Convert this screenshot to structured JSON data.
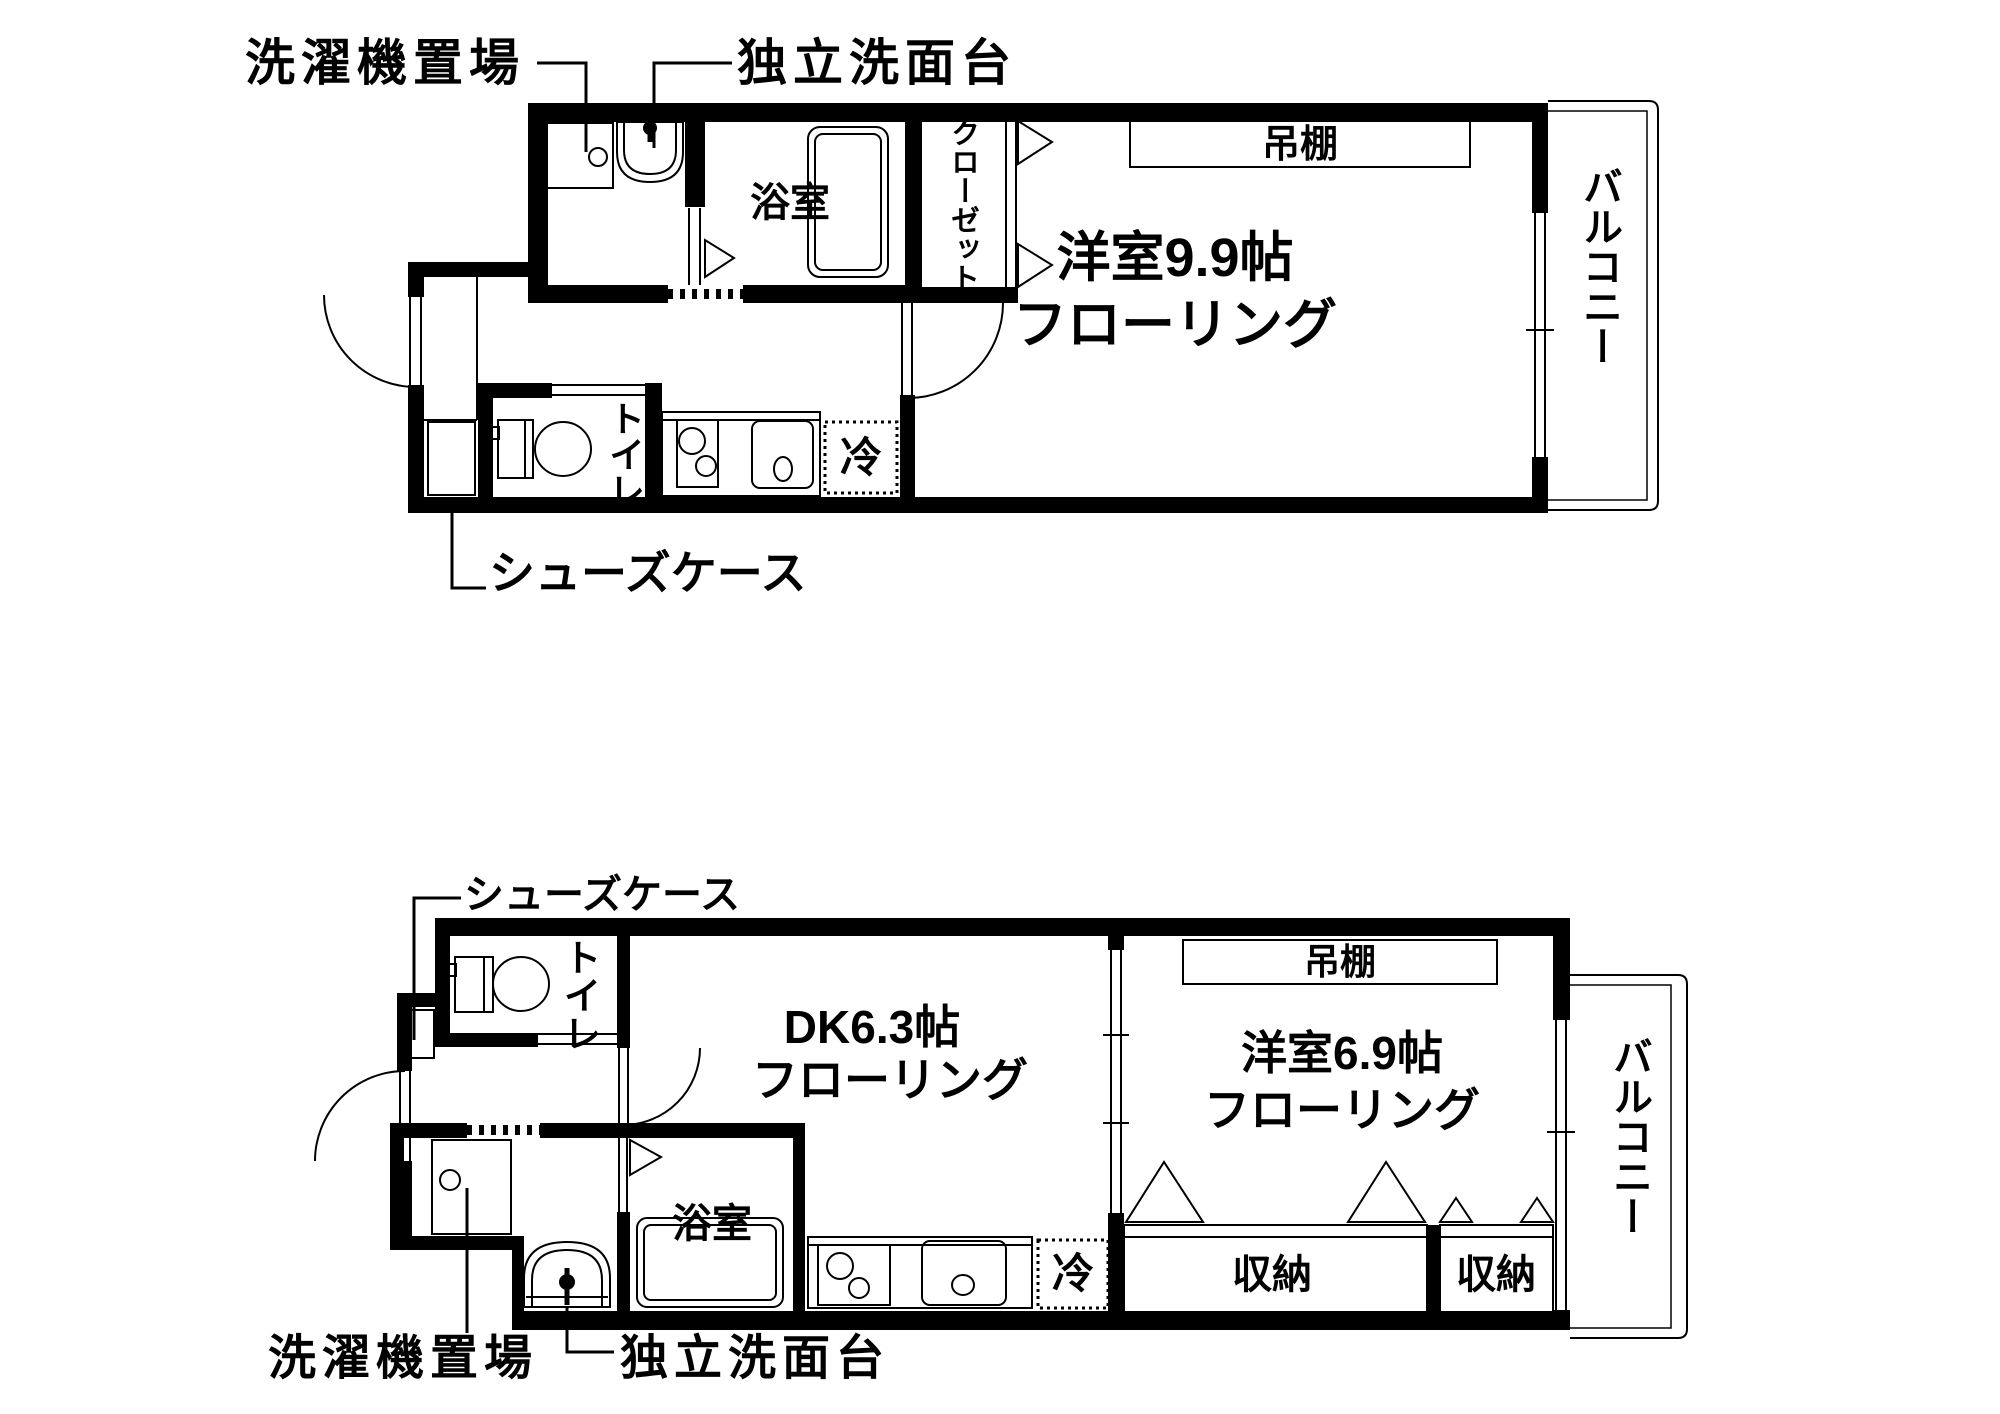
{
  "document": {
    "type": "apartment-floor-plan",
    "background_color": "#ffffff",
    "line_color": "#000000"
  },
  "upper": {
    "labels": {
      "washer": "洗濯機置場",
      "vanity": "独立洗面台",
      "bathroom": "浴室",
      "closet": "クローゼット",
      "shelf": "吊棚",
      "room_line1": "洋室9.9帖",
      "room_line2": "フローリング",
      "balcony": "バルコニー",
      "toilet": "トイレ",
      "fridge": "冷",
      "shoecase": "シューズケース"
    }
  },
  "lower": {
    "labels": {
      "shoecase": "シューズケース",
      "toilet": "トイレ",
      "dk_line1": "DK6.3帖",
      "dk_line2": "フローリング",
      "shelf": "吊棚",
      "room_line1": "洋室6.9帖",
      "room_line2": "フローリング",
      "balcony": "バルコニー",
      "bathroom": "浴室",
      "fridge": "冷",
      "storage1": "収納",
      "storage2": "収納",
      "washer": "洗濯機置場",
      "vanity": "独立洗面台"
    }
  }
}
